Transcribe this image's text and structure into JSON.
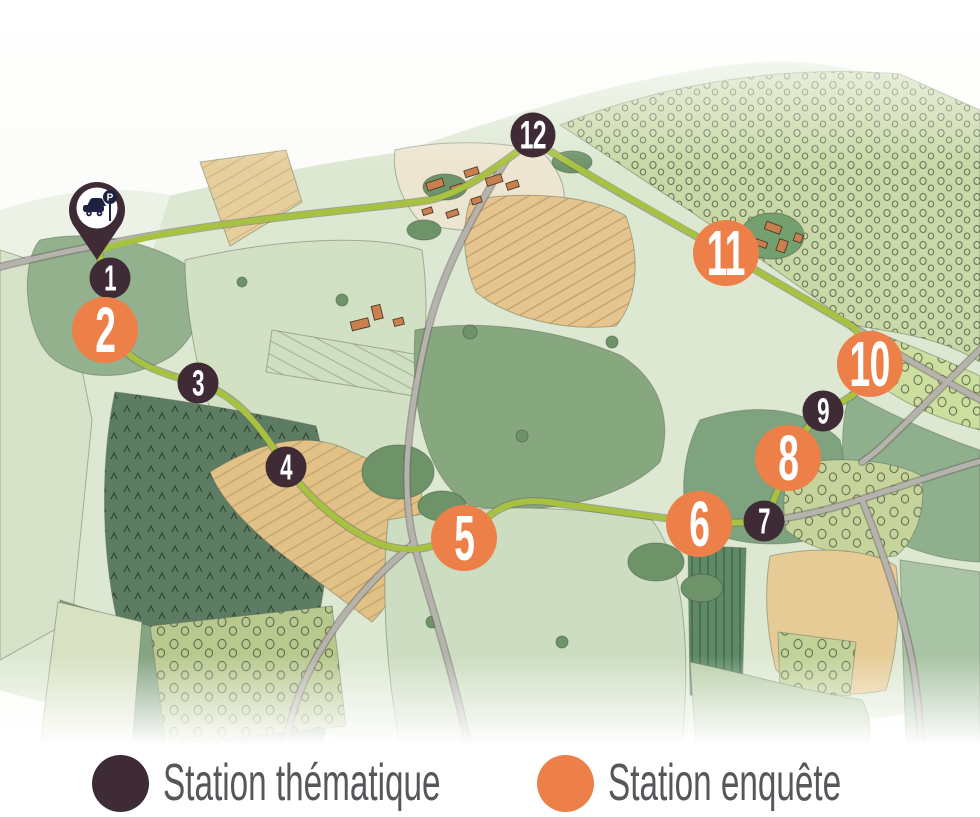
{
  "legend": {
    "items": [
      {
        "label": "Station thématique",
        "type": "thematic",
        "color": "#3E2B35"
      },
      {
        "label": "Station enquête",
        "type": "survey",
        "color": "#ED8049"
      }
    ]
  },
  "map": {
    "route_color": "#A7C240",
    "road_color": "#B6B3AE",
    "parking_pin": {
      "icon": "car-parking-pin",
      "glyph": "P",
      "x": 97,
      "y": 212
    },
    "stations": [
      {
        "num": "1",
        "type": "thematic",
        "size": "small",
        "x": 110,
        "y": 278
      },
      {
        "num": "2",
        "type": "survey",
        "size": "large",
        "x": 105,
        "y": 330
      },
      {
        "num": "3",
        "type": "thematic",
        "size": "small",
        "x": 198,
        "y": 383
      },
      {
        "num": "4",
        "type": "thematic",
        "size": "small",
        "x": 286,
        "y": 467
      },
      {
        "num": "5",
        "type": "survey",
        "size": "large",
        "x": 464,
        "y": 538
      },
      {
        "num": "6",
        "type": "survey",
        "size": "large",
        "x": 699,
        "y": 524
      },
      {
        "num": "7",
        "type": "thematic",
        "size": "small",
        "x": 764,
        "y": 521
      },
      {
        "num": "8",
        "type": "survey",
        "size": "large",
        "x": 788,
        "y": 458
      },
      {
        "num": "9",
        "type": "thematic",
        "size": "small",
        "x": 823,
        "y": 411
      },
      {
        "num": "10",
        "type": "survey",
        "size": "large",
        "x": 870,
        "y": 364
      },
      {
        "num": "11",
        "type": "survey",
        "size": "large",
        "x": 726,
        "y": 253
      },
      {
        "num": "12",
        "type": "thematic",
        "size": "medium",
        "x": 533,
        "y": 135
      }
    ]
  }
}
